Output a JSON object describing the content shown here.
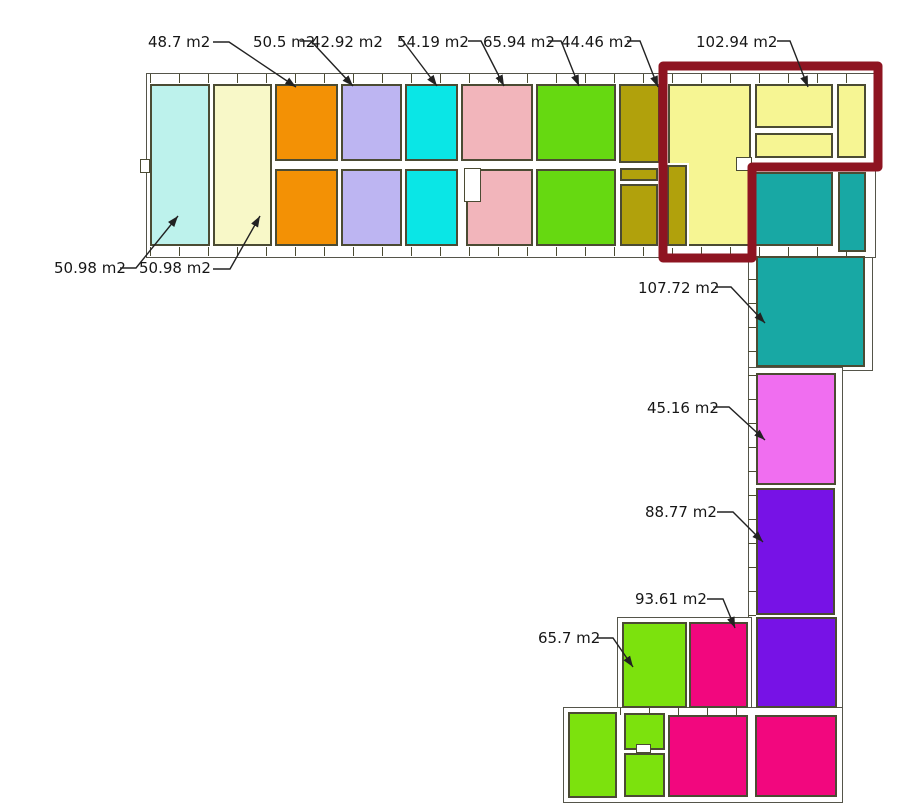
{
  "plan": {
    "title": "floor-plan",
    "unit": "m2",
    "background": "#ffffff",
    "wall_color": "#4b4b33",
    "leader_color": "#222222",
    "highlight_color": "#8e1421"
  },
  "colors": {
    "light_cyan": "#bdf2ec",
    "cream": "#f8f8c8",
    "orange": "#f39105",
    "lavender": "#bdb5f2",
    "cyan": "#0ae6e6",
    "pink": "#f2b5bb",
    "green": "#66d911",
    "olive": "#b1a10c",
    "pale_yellow": "#f6f593",
    "teal": "#18a8a4",
    "magenta": "#f06ef0",
    "purple": "#7712e6",
    "bright_green": "#7ce20d",
    "crimson": "#f2077e"
  },
  "rooms": [
    {
      "id": "left-room-1",
      "color": "light_cyan",
      "area": "50.98 m2"
    },
    {
      "id": "left-room-2",
      "color": "cream",
      "area": "50.98 m2"
    },
    {
      "id": "orange-top",
      "color": "orange",
      "area": "48.7 m2"
    },
    {
      "id": "orange-bottom",
      "color": "orange"
    },
    {
      "id": "lavender-top",
      "color": "lavender",
      "area": "50.5 m2"
    },
    {
      "id": "lavender-bottom",
      "color": "lavender"
    },
    {
      "id": "cyan-top",
      "color": "cyan",
      "area": "42.92 m2"
    },
    {
      "id": "cyan-bottom",
      "color": "cyan"
    },
    {
      "id": "pink-top",
      "color": "pink",
      "area": "54.19 m2"
    },
    {
      "id": "pink-bottom",
      "color": "pink"
    },
    {
      "id": "green-top",
      "color": "green",
      "area": "65.94 m2"
    },
    {
      "id": "green-bottom",
      "color": "green"
    },
    {
      "id": "olive-top",
      "color": "olive",
      "area": "44.46 m2"
    },
    {
      "id": "olive-mid",
      "color": "olive"
    },
    {
      "id": "olive-bottom",
      "color": "olive"
    },
    {
      "id": "olive-strip",
      "color": "olive"
    },
    {
      "id": "yellow-main",
      "color": "pale_yellow",
      "selected": true
    },
    {
      "id": "yellow-top-right",
      "color": "pale_yellow",
      "area": "102.94 m2",
      "selected": true
    },
    {
      "id": "yellow-strip",
      "color": "pale_yellow",
      "selected": true
    },
    {
      "id": "yellow-right-narrow",
      "color": "pale_yellow",
      "selected": true
    },
    {
      "id": "teal-wide",
      "color": "teal"
    },
    {
      "id": "teal-narrow",
      "color": "teal"
    },
    {
      "id": "teal-large",
      "color": "teal",
      "area": "107.72 m2"
    },
    {
      "id": "magenta-room",
      "color": "magenta",
      "area": "45.16 m2"
    },
    {
      "id": "purple-upper",
      "color": "purple",
      "area": "88.77 m2"
    },
    {
      "id": "purple-lower",
      "color": "purple"
    },
    {
      "id": "green-mid-row",
      "color": "bright_green",
      "area": "65.7 m2"
    },
    {
      "id": "crimson-mid-row",
      "color": "crimson",
      "area": "93.61 m2"
    },
    {
      "id": "green-bottom-tall",
      "color": "bright_green"
    },
    {
      "id": "green-bottom-small-1",
      "color": "bright_green"
    },
    {
      "id": "green-bottom-small-2",
      "color": "bright_green"
    },
    {
      "id": "crimson-bottom-mid",
      "color": "crimson"
    },
    {
      "id": "crimson-bottom-right",
      "color": "crimson"
    }
  ],
  "labels": [
    {
      "text": "48.7 m2",
      "room": "orange-top"
    },
    {
      "text": "50.5 m2",
      "room": "lavender-top"
    },
    {
      "text": "42.92 m2",
      "room": "cyan-top"
    },
    {
      "text": "54.19 m2",
      "room": "pink-top"
    },
    {
      "text": "65.94 m2",
      "room": "green-top"
    },
    {
      "text": "44.46 m2",
      "room": "olive-top"
    },
    {
      "text": "102.94 m2",
      "room": "yellow-top-right"
    },
    {
      "text": "50.98 m2",
      "room": "left-room-1"
    },
    {
      "text": "50.98 m2",
      "room": "left-room-2"
    },
    {
      "text": "107.72 m2",
      "room": "teal-large"
    },
    {
      "text": "45.16 m2",
      "room": "magenta-room"
    },
    {
      "text": "88.77 m2",
      "room": "purple-upper"
    },
    {
      "text": "93.61 m2",
      "room": "crimson-mid-row"
    },
    {
      "text": "65.7 m2",
      "room": "green-mid-row"
    }
  ]
}
